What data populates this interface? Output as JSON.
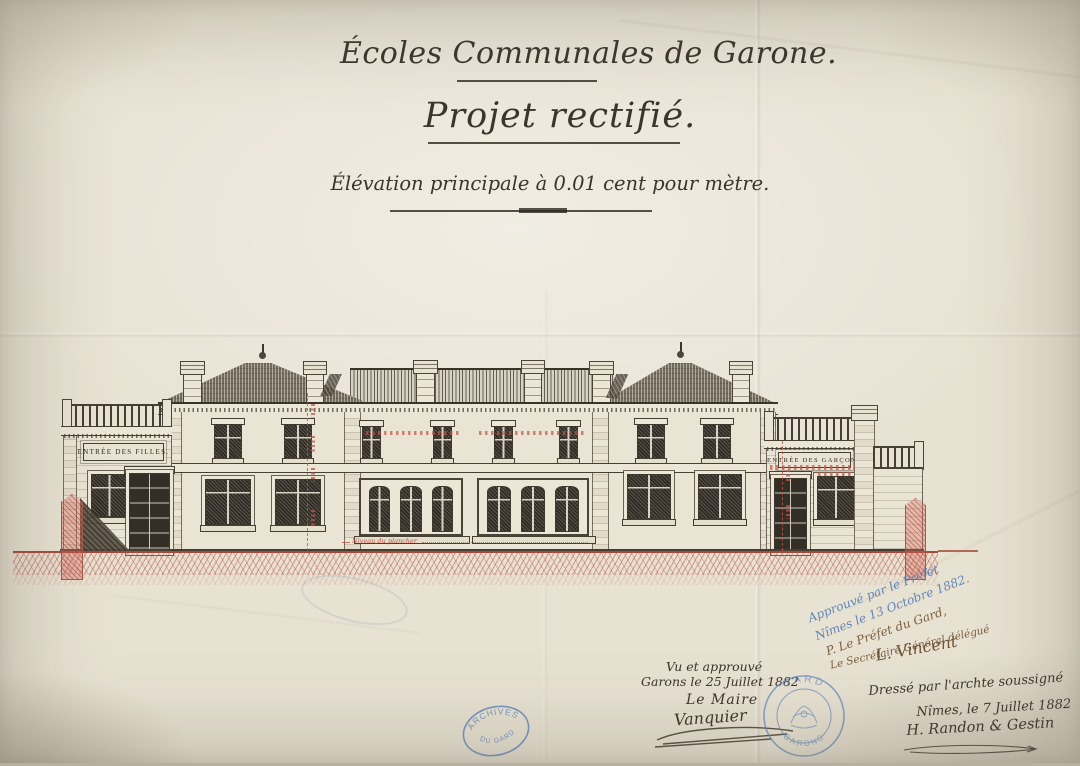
{
  "titles": {
    "main": "Écoles Communales de Garone.",
    "project": "Projet rectifié.",
    "scale": "Élévation principale à 0.01 cent pour mètre."
  },
  "building": {
    "girls_plaque": "ENTRÉE DES FILLES.",
    "boys_plaque": "ENTRÉE DES GARÇONS",
    "floor_note": "Niveau du plancher"
  },
  "approvals": {
    "prefect_blue_line1": "Approuvé par le Préfet",
    "prefect_blue_line2": "Nîmes le 13 Octobre 1882.",
    "prefect_brown_line1": "P. Le Préfet du Gard,",
    "prefect_brown_line2": "Le Secrétaire Général délégué",
    "prefect_signature": "L. Vincent",
    "mayor_line1": "Vu et approuvé",
    "mayor_line2": "Garons le 25 Juillet 1882",
    "mayor_line3": "Le Maire",
    "mayor_signature": "Vanquier",
    "architect_line1": "Dressé par l'archte soussigné",
    "architect_line2": "Nîmes, le 7 Juillet 1882",
    "architect_signature": "H. Randon & Gestin"
  },
  "stamps": {
    "round_top": "GARD",
    "round_bottom": "GARONS",
    "oval_top": "ARCHIVES",
    "oval_bottom": "DU GARD"
  },
  "colors": {
    "paper": "#e8e2d3",
    "ink": "#3c352b",
    "red_ink": "#bf5244",
    "blue_stamp": "#5f87ba",
    "brown_ink": "#7b5f3e"
  }
}
